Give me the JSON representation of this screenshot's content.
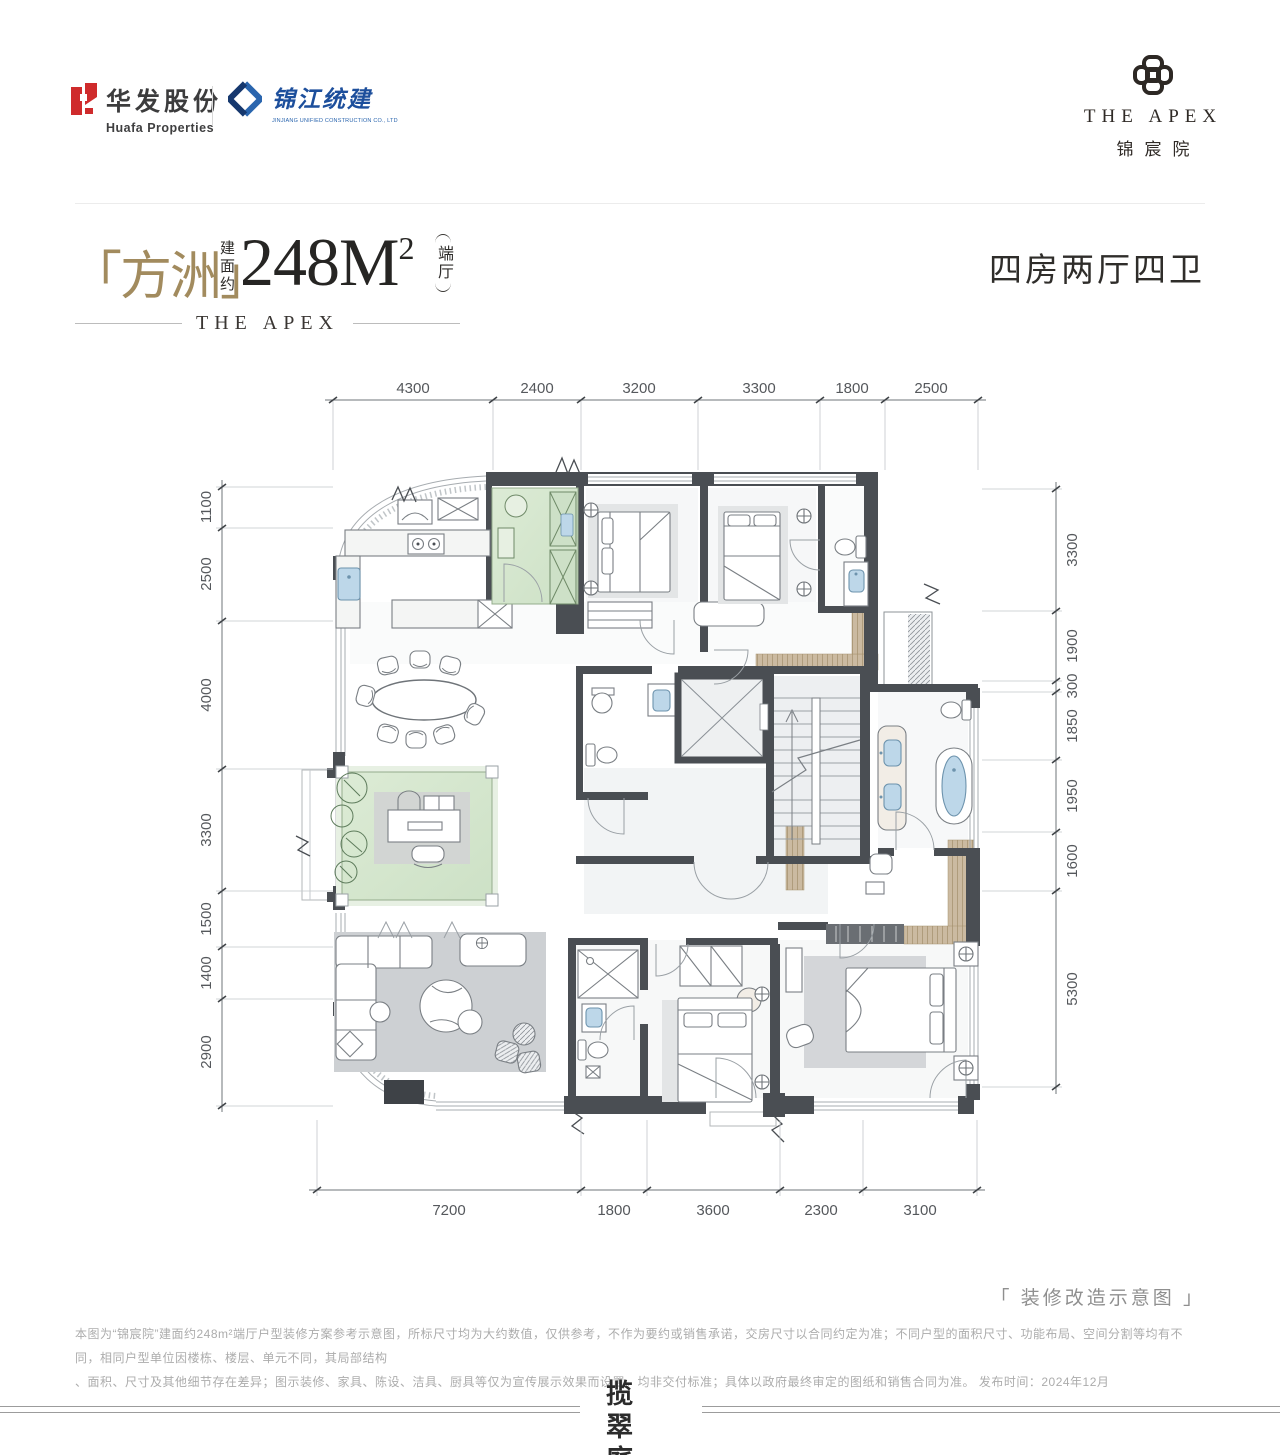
{
  "header": {
    "huafa": {
      "name_cn": "华发股份",
      "name_en": "Huafa Properties"
    },
    "jinjiang": {
      "name_cn": "锦江统建",
      "name_en": "JINJIANG UNIFIED CONSTRUCTION CO., LTD"
    },
    "apex": {
      "name_en": "THE APEX",
      "name_cn": "锦宸院"
    }
  },
  "title": {
    "name": "「方洲」",
    "area_prefix": "建面约",
    "area_value": "248",
    "area_unit": "M",
    "area_sup": "2",
    "area_tag": "端厅",
    "subtitle": "THE APEX",
    "layout_spec": "四房两厅四卫"
  },
  "dimensions": {
    "top": [
      "4300",
      "2400",
      "3200",
      "3300",
      "1800",
      "2500"
    ],
    "bottom": [
      "7200",
      "1800",
      "3600",
      "2300",
      "3100"
    ],
    "left": [
      "1100",
      "2500",
      "4000",
      "3300",
      "1500",
      "1400",
      "2900"
    ],
    "right": [
      "3300",
      "1900",
      "300",
      "1850",
      "1950",
      "1600",
      "5300"
    ]
  },
  "footer": {
    "note": "「 装修改造示意图 」",
    "disclaimer_line1": "本图为“锦宸院”建面约248m²端厅户型装修方案参考示意图，所标尺寸均为大约数值，仅供参考，不作为要约或销售承诺，交房尺寸以合同约定为准；不同户型的面积尺寸、功能布局、空间分割等均有不同，相同户型单位因楼栋、楼层、单元不同，其局部结构",
    "disclaimer_line2": "、面积、尺寸及其他细节存在差异；图示装修、家具、陈设、洁具、厨具等仅为宣传展示效果而设置，均非交付标准；具体以政府最终审定的图纸和销售合同为准。  发布时间：2024年12月",
    "brand_row1": "揽翠",
    "brand_row2": "庭院"
  },
  "colors": {
    "accent_gold": "#a28b5e",
    "wall": "#4a4e53",
    "green_room": "#d6e6d0",
    "fixture_blue": "#bdd7e9",
    "deck_wood": "#cbbaa1",
    "logo_red": "#cf2b2c",
    "logo_blue": "#2a65ae"
  }
}
